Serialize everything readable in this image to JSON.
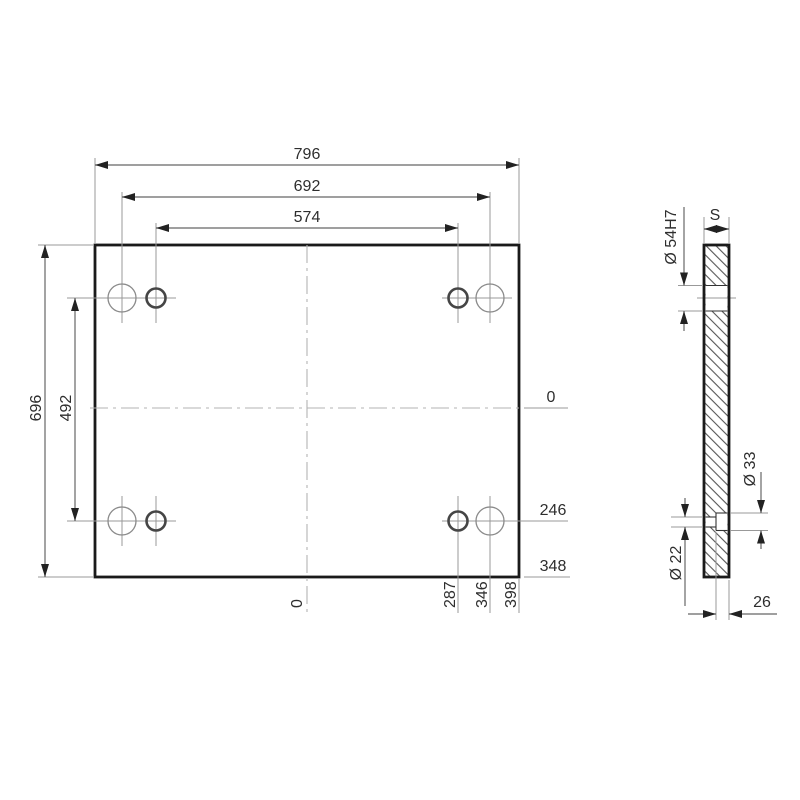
{
  "drawing": {
    "background_color": "#ffffff",
    "outline_color": "#1a1a1a",
    "dimension_line_color": "#666666",
    "front_view": {
      "top_dimensions": [
        "796",
        "692",
        "574"
      ],
      "left_dimensions": [
        "696",
        "492"
      ],
      "right_ordinates": [
        "0",
        "246",
        "348"
      ],
      "bottom_ordinates": [
        "0",
        "287",
        "346",
        "398"
      ]
    },
    "side_view": {
      "thickness_label": "S",
      "bore_diameter_label": "Ø 54H7",
      "counterbore_diameter_label": "Ø 33",
      "through_hole_diameter_label": "Ø 22",
      "counterbore_depth_label": "26"
    }
  }
}
